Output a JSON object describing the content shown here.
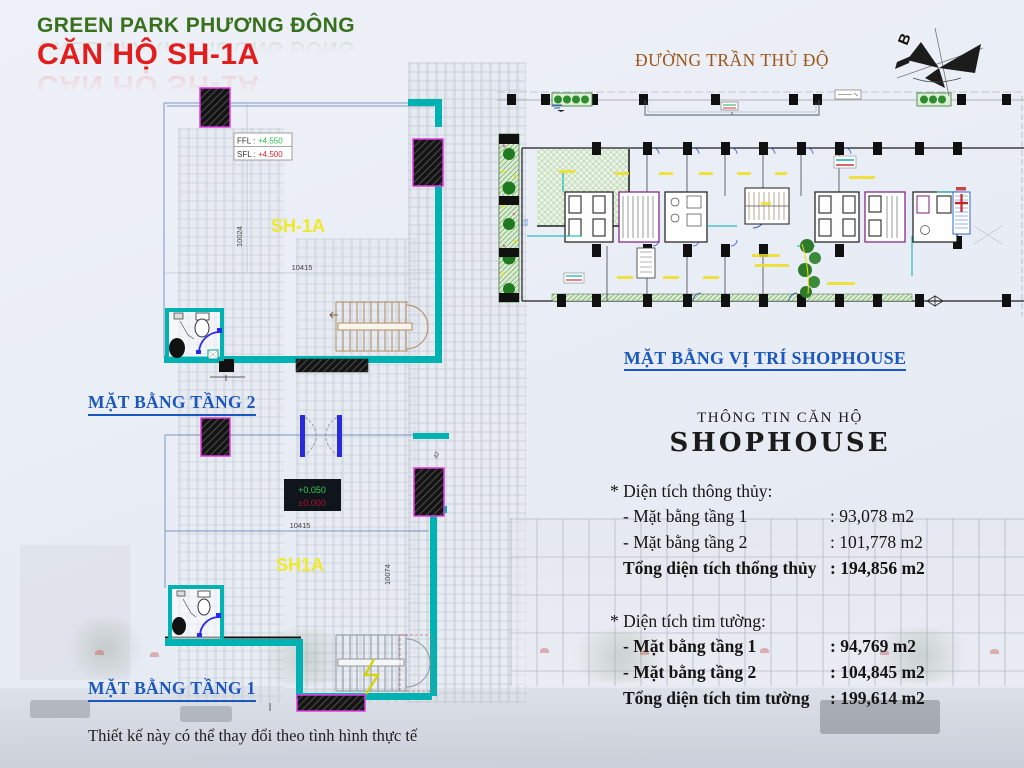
{
  "header": {
    "project": "GREEN PARK PHƯƠNG ĐÔNG",
    "unit": "CĂN HỘ SH-1A",
    "street": "ĐƯỜNG TRẦN THỦ ĐỘ",
    "compass_label": "B"
  },
  "plans": {
    "floor2": {
      "label": "MẶT BẰNG TẦNG 2",
      "unit_label": "SH-1A",
      "ffl_label": "FFL :",
      "ffl_value": "+4.550",
      "sfl_label": "SFL :",
      "sfl_value": "+4.500",
      "dim_width": "10415",
      "dim_height": "10024"
    },
    "floor1": {
      "label": "MẶT BẰNG TẦNG 1",
      "unit_label": "SH1A",
      "level_top": "+0.050",
      "level_bottom": "±0.000",
      "dim_width": "10415",
      "dim_height": "10074",
      "dim_small": "42"
    },
    "site": {
      "label": "MẶT BẰNG VỊ TRÍ SHOPHOUSE"
    }
  },
  "info": {
    "title_small": "THÔNG TIN CĂN HỘ",
    "title_big": "SHOPHOUSE",
    "section1": {
      "heading": "* Diện tích thông thủy:",
      "row1_label": "- Mặt bằng tầng 1",
      "row1_value": ": 93,078 m2",
      "row2_label": "- Mặt bằng tầng 2",
      "row2_value": ": 101,778 m2",
      "total_label": "Tổng diện tích thổng thủy",
      "total_value": ": 194,856 m2"
    },
    "section2": {
      "heading": "* Diện tích tim tường:",
      "row1_label": "- Mặt bằng tầng 1",
      "row1_value": ": 94,769 m2",
      "row2_label": "- Mặt bằng tầng 2",
      "row2_value": ": 104,845 m2",
      "total_label": "Tổng diện tích tim tường",
      "total_value": ": 199,614 m2"
    }
  },
  "footer": {
    "note": "Thiết kế này có thể thay đổi theo tình hình thực tế"
  },
  "colors": {
    "wall_teal": "#00b2b2",
    "column_magenta": "#e33ae3",
    "unit_yellow": "#eeea2a",
    "caption_blue": "#1a57be",
    "title_green": "#39701e",
    "title_red": "#e21d1d",
    "street_brown": "#9c5417",
    "ffl_green": "#22bb44",
    "sfl_red": "#dd2233"
  }
}
